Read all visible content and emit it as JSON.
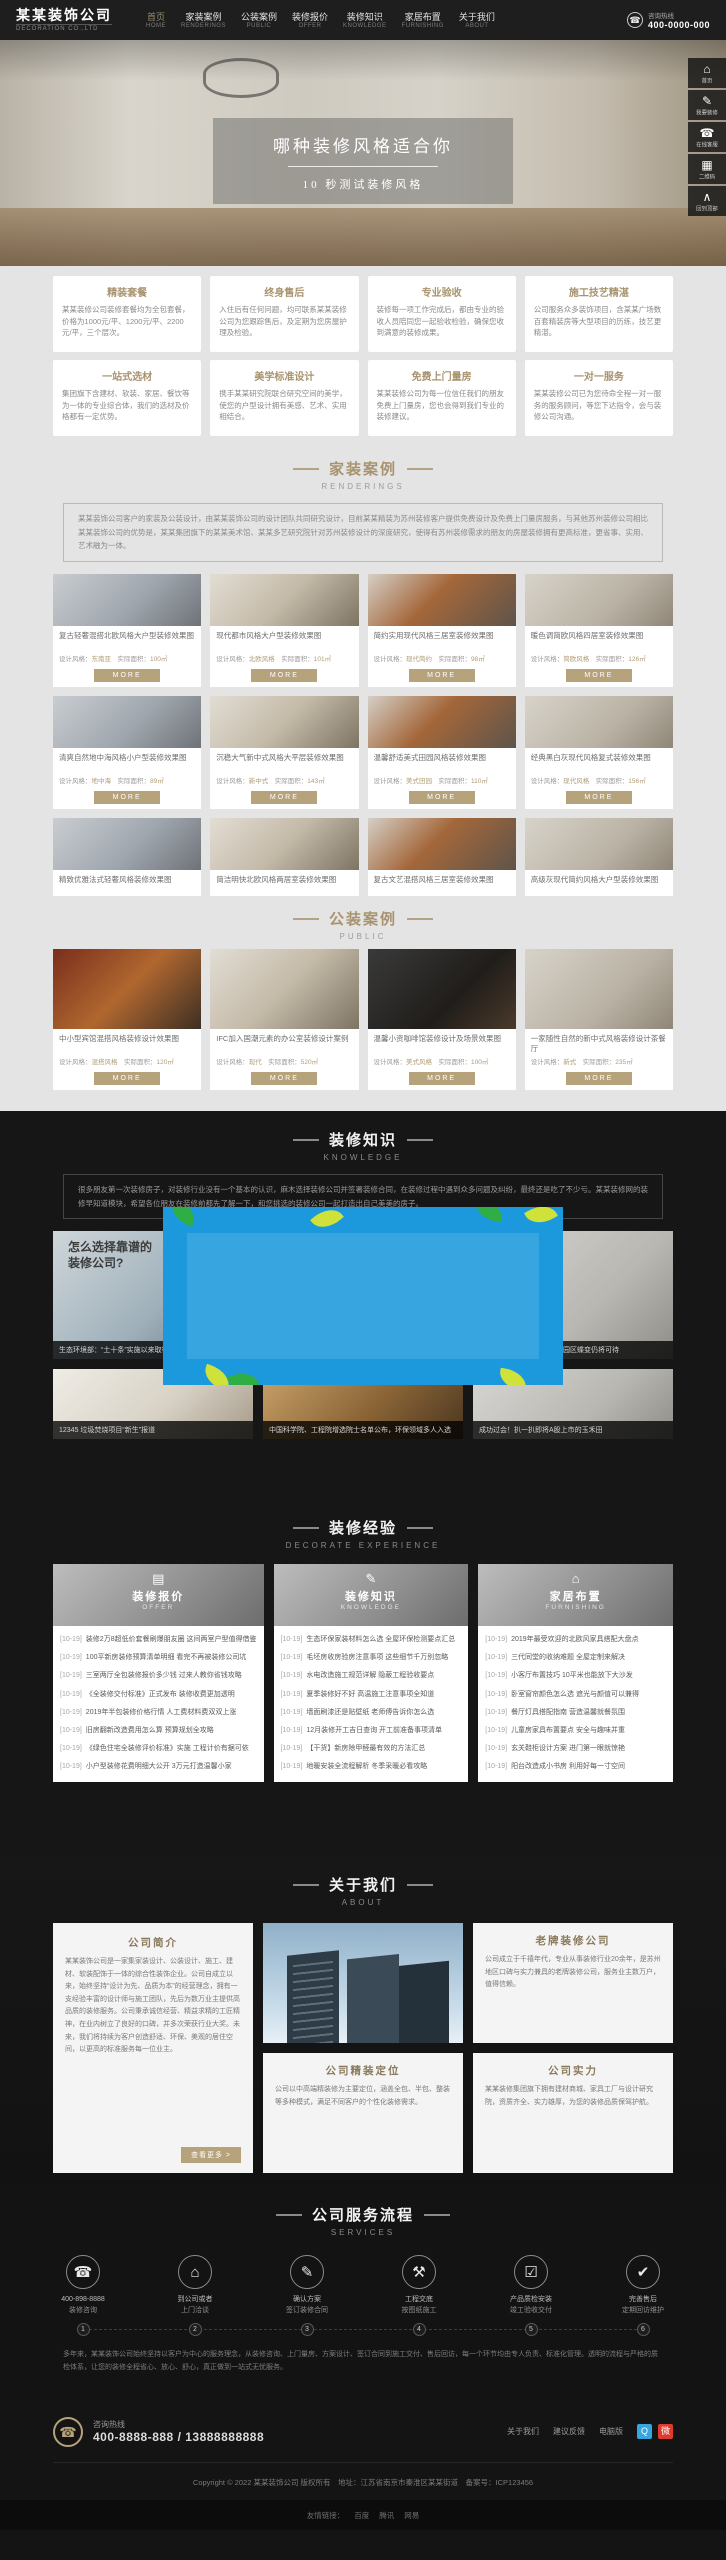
{
  "brand": {
    "logo": "某某装饰公司",
    "logo_sub": "DECORATION CO.,LTD"
  },
  "header": {
    "hotline_label": "咨询热线",
    "hotline_number": "400-0000-000",
    "phone_glyph": "☎",
    "nav": [
      {
        "zh": "首页",
        "en": "HOME"
      },
      {
        "zh": "家装案例",
        "en": "RENDERINGS"
      },
      {
        "zh": "公装案例",
        "en": "PUBLIC"
      },
      {
        "zh": "装修报价",
        "en": "OFFER"
      },
      {
        "zh": "装修知识",
        "en": "KNOWLEDGE"
      },
      {
        "zh": "家居布置",
        "en": "FURNISHING"
      },
      {
        "zh": "关于我们",
        "en": "ABOUT"
      }
    ]
  },
  "banner": {
    "title": "哪种装修风格适合你",
    "subtitle": "10 秒测试装修风格"
  },
  "floatbar": {
    "items": [
      {
        "icon_name": "home-icon",
        "glyph": "⌂",
        "label": "首页"
      },
      {
        "icon_name": "decorate-icon",
        "glyph": "✎",
        "label": "我要装修"
      },
      {
        "icon_name": "service-icon",
        "glyph": "☎",
        "label": "在线客服"
      },
      {
        "icon_name": "qrcode-icon",
        "glyph": "▦",
        "label": "二维码"
      },
      {
        "icon_name": "backtop-icon",
        "glyph": "∧",
        "label": "回到顶部"
      }
    ]
  },
  "features": {
    "row1": [
      {
        "title": "精装套餐",
        "body": "某某装修公司装修套餐均为全包套餐，价格为1000元/平、1200元/平、2200元/平，三个层次。"
      },
      {
        "title": "终身售后",
        "body": "入住后有任何问题，均可联系某某装修公司为您跟踪售后，及定期为您房屋护理及检验。"
      },
      {
        "title": "专业验收",
        "body": "装修每一项工作完成后，都由专业的验收人员陪同您一起验收检验，确保您收到满意的装修成果。"
      },
      {
        "title": "施工技艺精湛",
        "body": "公司服务众多装饰项目，含某某广场数百套精装房等大型项目的历练，技艺更精湛。"
      }
    ],
    "row2": [
      {
        "title": "一站式选材",
        "body": "集团旗下含建材、软装、家居、餐饮等为一体的专业综合体，我们的选材及价格都有一定优势。"
      },
      {
        "title": "美学标准设计",
        "body": "携手某某研究院联合研究空间的美学，使您的户型设计拥有美感、艺术、实用相结合。"
      },
      {
        "title": "免费上门量房",
        "body": "某某装修公司为每一位信任我们的朋友免费上门量房，您也会得到我们专业的装修建议。"
      },
      {
        "title": "一对一服务",
        "body": "某某装修公司已为您待命全程一对一服务的服务顾问，等您下达指令，会与装修公司沟通。"
      }
    ]
  },
  "renderings": {
    "title_zh": "家装案例",
    "title_en": "RENDERINGS",
    "intro": "某某装饰公司客户的家装及公装设计，由某某装饰公司的设计团队共同研究设计，目前某某精装为苏州装修客户提供免费设计及免费上门量房服务，与其他苏州装修公司相比某某装饰公司的优势是，某某集团旗下的某某美术馆、某某多艺研究院针对苏州装修设计的深度研究，使得有苏州装修需求的朋友的房屋装修拥有更高标准，更省事、实用、艺术融为一体。",
    "labels": {
      "style": "设计风格：",
      "area": "实际面积："
    },
    "more_label": "MORE",
    "cards": [
      {
        "title": "复古轻奢混搭北欧风格大户型装修效果图",
        "style": "东南亚",
        "area": "100㎡"
      },
      {
        "title": "现代都市风格大户型装修效果图",
        "style": "北欧风格",
        "area": "101㎡"
      },
      {
        "title": "简约实用现代风格三居室装修效果图",
        "style": "现代简约",
        "area": "98㎡"
      },
      {
        "title": "暖色调简欧风格四居室装修效果图",
        "style": "简欧风格",
        "area": "126㎡"
      },
      {
        "title": "清爽自然地中海风格小户型装修效果图",
        "style": "地中海",
        "area": "89㎡"
      },
      {
        "title": "沉稳大气新中式风格大平层装修效果图",
        "style": "新中式",
        "area": "143㎡"
      },
      {
        "title": "温馨舒适美式田园风格装修效果图",
        "style": "美式田园",
        "area": "110㎡"
      },
      {
        "title": "经典黑白灰现代风格复式装修效果图",
        "style": "现代风格",
        "area": "156㎡"
      },
      {
        "title": "精致优雅法式轻奢风格装修效果图",
        "style": "法式轻奢",
        "area": "120㎡"
      },
      {
        "title": "简洁明快北欧风格两居室装修效果图",
        "style": "北欧风格",
        "area": "85㎡"
      },
      {
        "title": "复古文艺混搭风格三居室装修效果图",
        "style": "混搭风格",
        "area": "102㎡"
      },
      {
        "title": "高级灰现代简约风格大户型装修效果图",
        "style": "现代简约",
        "area": "135㎡"
      }
    ]
  },
  "public_cases": {
    "title_zh": "公装案例",
    "title_en": "PUBLIC",
    "labels": {
      "style": "设计风格：",
      "area": "实际面积："
    },
    "more_label": "MORE",
    "cards": [
      {
        "title": "中小型宾馆混搭风格装修设计效果图",
        "style": "混搭风格",
        "area": "120㎡"
      },
      {
        "title": "IFC加入国潮元素的办公室装修设计案例",
        "style": "现代",
        "area": "520㎡"
      },
      {
        "title": "温馨小资咖啡馆装修设计及场景效果图",
        "style": "美式风格",
        "area": "100㎡"
      },
      {
        "title": "一家随性自然的新中式风格装修设计茶餐厅",
        "style": "新式",
        "area": "235㎡"
      }
    ]
  },
  "knowledge": {
    "title_zh": "装修知识",
    "title_en": "KNOWLEDGE",
    "intro": "很多朋友第一次装修房子，对装修行业没有一个基本的认识，麻木选择装修公司并签署装修合同，在装修过程中遇到众多问题及纠纷，最终还是吃了不少亏。某某装修网的装修早知道模块，希望各位朋友在装修前都先了解一下，和您挑选的装修公司一起打造出自己美美的房子。",
    "ad_line1": "怎么选择靠谱的",
    "ad_line2": "装修公司?",
    "news_row1": [
      {
        "caption": "生态环境部：“土十条”实施以来取得积极成效"
      },
      {
        "caption": "共商共建 联防联控，千亿长江生态基金在路上"
      },
      {
        "caption": "循环经济、创新引领，化工园区蝶变仍将可待"
      }
    ],
    "news_row2": [
      {
        "caption": "12345 垃圾焚烧项目“新生”报道"
      },
      {
        "caption": "中国科学院、工程院增选院士名单公布，环保领域多人入选"
      },
      {
        "caption": "成功过会！扒一扒即将A股上市的玉禾田"
      }
    ]
  },
  "experience": {
    "title_zh": "装修经验",
    "title_en": "DECORATE EXPERIENCE",
    "columns": [
      {
        "icon_name": "offer-icon",
        "glyph": "▤",
        "zh": "装修报价",
        "en": "OFFER",
        "items": [
          {
            "date": "[10-19]",
            "text": "装修2万8超低价套餐刷爆朋友圈 这间两室户型值得借鉴"
          },
          {
            "date": "[10-19]",
            "text": "100平新房装修预算清单明细 看完不再被装修公司坑"
          },
          {
            "date": "[10-19]",
            "text": "三室两厅全包装修报价多少钱 过来人教你省钱攻略"
          },
          {
            "date": "[10-19]",
            "text": "《全装修交付标准》正式发布 装修收费更加透明"
          },
          {
            "date": "[10-19]",
            "text": "2019年半包装修价格行情 人工费材料费双双上涨"
          },
          {
            "date": "[10-19]",
            "text": "旧房翻新改造费用怎么算 预算规划全攻略"
          },
          {
            "date": "[10-19]",
            "text": "《绿色住宅全装修评价标准》实施 工程计价有据可依"
          },
          {
            "date": "[10-19]",
            "text": "小户型装修花费明细大公开 3万元打造温馨小家"
          }
        ]
      },
      {
        "icon_name": "knowledge-icon",
        "glyph": "✎",
        "zh": "装修知识",
        "en": "KNOWLEDGE",
        "items": [
          {
            "date": "[10-19]",
            "text": "生态环保家装材料怎么选 全屋环保检测要点汇总"
          },
          {
            "date": "[10-19]",
            "text": "毛坯房收房验房注意事项 这些细节千万别忽略"
          },
          {
            "date": "[10-19]",
            "text": "水电改造施工规范详解 隐蔽工程验收要点"
          },
          {
            "date": "[10-19]",
            "text": "夏季装修好不好 高温施工注意事项全知道"
          },
          {
            "date": "[10-19]",
            "text": "墙面刷漆还是贴壁纸 老师傅告诉你怎么选"
          },
          {
            "date": "[10-19]",
            "text": "12月装修开工吉日查询 开工前准备事项清单"
          },
          {
            "date": "[10-19]",
            "text": "【干货】新房除甲醛最有效的方法汇总"
          },
          {
            "date": "[10-19]",
            "text": "地暖安装全流程解析 冬季采暖必看攻略"
          }
        ]
      },
      {
        "icon_name": "furnishing-icon",
        "glyph": "⌂",
        "zh": "家居布置",
        "en": "FURNISHING",
        "items": [
          {
            "date": "[10-19]",
            "text": "2019年最受欢迎的北欧风家具搭配大盘点"
          },
          {
            "date": "[10-19]",
            "text": "三代同堂的收纳难题 全屋定制来解决"
          },
          {
            "date": "[10-19]",
            "text": "小客厅布置技巧 10平米也能放下大沙发"
          },
          {
            "date": "[10-19]",
            "text": "卧室窗帘颜色怎么选 遮光与颜值可以兼得"
          },
          {
            "date": "[10-19]",
            "text": "餐厅灯具搭配指南 营造温馨就餐氛围"
          },
          {
            "date": "[10-19]",
            "text": "儿童房家具布置要点 安全与趣味并重"
          },
          {
            "date": "[10-19]",
            "text": "玄关鞋柜设计方案 进门第一眼就惊艳"
          },
          {
            "date": "[10-19]",
            "text": "阳台改造成小书房 利用好每一寸空间"
          }
        ]
      }
    ]
  },
  "about": {
    "title_zh": "关于我们",
    "title_en": "ABOUT",
    "intro_title": "公司简介",
    "intro_text": "某某装饰公司是一家集家装设计、公装设计、施工、建材、软装配饰于一体的综合性装饰企业。公司自成立以来，始终坚持“设计为先、品质为本”的经营理念，拥有一支经验丰富的设计师与施工团队，先后为数万业主提供高品质的装修服务。公司秉承诚信经营、精益求精的工匠精神，在业内树立了良好的口碑，并多次荣获行业大奖。未来，我们将持续为客户创造舒适、环保、美观的居住空间，以更高的标准服务每一位业主。",
    "intro_more": "查看更多 >",
    "cards": [
      {
        "title": "老牌装修公司",
        "text": "公司成立于千禧年代，专业从事装修行业20余年，是苏州地区口碑与实力兼具的老牌装修公司，服务业主数万户，值得信赖。"
      },
      {
        "title": "公司精装定位",
        "text": "公司以中高端精装修为主要定位，涵盖全包、半包、整装等多种模式，满足不同客户的个性化装修需求。"
      },
      {
        "title": "公司实力",
        "text": "某某装修集团旗下拥有建材商城、家具工厂与设计研究院，资质齐全、实力雄厚，为您的装修品质保驾护航。"
      }
    ]
  },
  "services": {
    "title_zh": "公司服务流程",
    "title_en": "SERVICES",
    "steps": [
      {
        "icon_name": "phone-icon",
        "glyph": "☎",
        "line1": "400-898-8888",
        "line2": "装修咨询",
        "num": "1"
      },
      {
        "icon_name": "visit-icon",
        "glyph": "⌂",
        "line1": "到公司或者",
        "line2": "上门洽谈",
        "num": "2"
      },
      {
        "icon_name": "contract-icon",
        "glyph": "✎",
        "line1": "确认方案",
        "line2": "签订装修合同",
        "num": "3"
      },
      {
        "icon_name": "construction-icon",
        "glyph": "⚒",
        "line1": "工程交底",
        "line2": "按图纸施工",
        "num": "4"
      },
      {
        "icon_name": "inspection-icon",
        "glyph": "☑",
        "line1": "产品质检安装",
        "line2": "竣工验收交付",
        "num": "5"
      },
      {
        "icon_name": "aftersale-icon",
        "glyph": "✔",
        "line1": "完善售后",
        "line2": "定期回访维护",
        "num": "6"
      }
    ],
    "note": "多年来，某某装饰公司始终坚持以客户为中心的服务理念，从装修咨询、上门量房、方案设计、签订合同到施工交付、售后回访，每一个环节均由专人负责、标准化管理。透明的流程与严格的质检体系，让您的装修全程省心、放心、舒心，真正做到一站式无忧服务。"
  },
  "footer": {
    "phone_glyph": "☎",
    "hotline_label": "咨询热线",
    "hotline_number": "400-8888-888 / 13888888888",
    "links": [
      "关于我们",
      "建议反馈",
      "电脑版"
    ],
    "social": [
      {
        "glyph": "Q"
      },
      {
        "glyph": "微"
      }
    ],
    "copyright": "Copyright © 2022 某某装饰公司 版权所有　地址：江苏省南京市秦淮区某某街道　备案号：ICP123456",
    "friend_label": "友情链接：",
    "friend_links": [
      "百度",
      "腾讯",
      "网易"
    ]
  }
}
